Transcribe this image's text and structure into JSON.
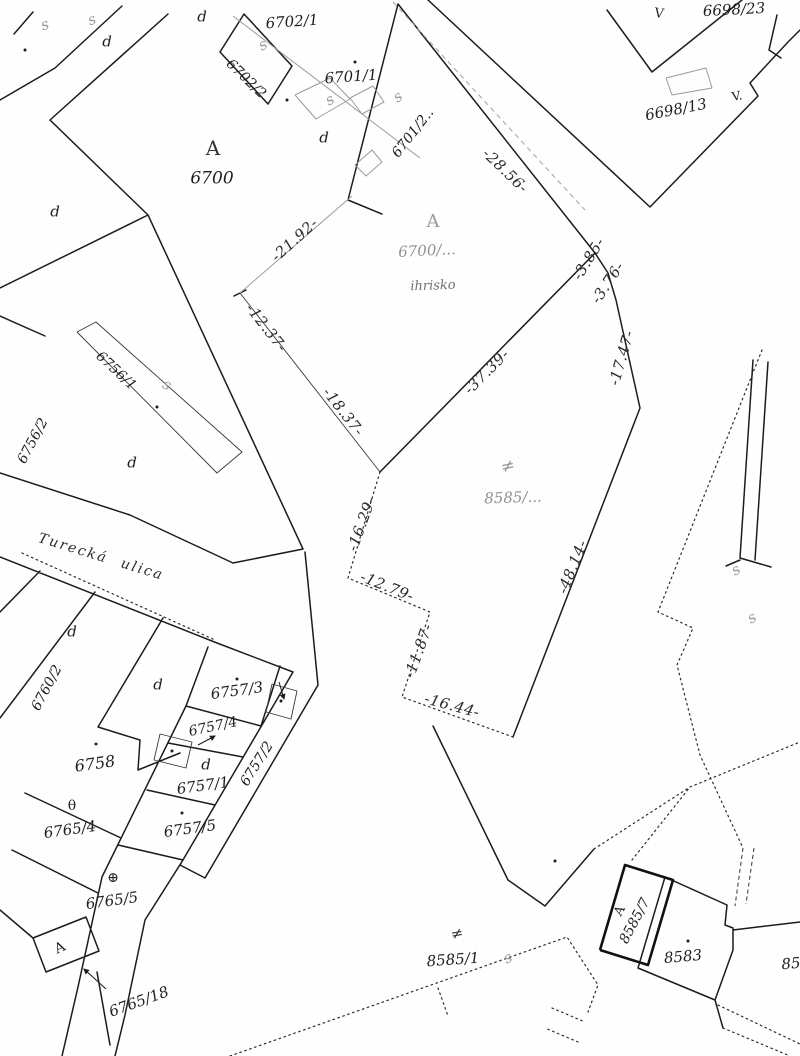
{
  "page": {
    "background": "#fefefe",
    "ink": "#1c1c1c",
    "faded_ink": "#919191",
    "kind": "cadastral map scan"
  },
  "street": {
    "label": "Turecká ulica",
    "x": 101,
    "y": 557,
    "rot": 17,
    "size": 14
  },
  "parcel_labels": [
    {
      "text": "6702/1",
      "x": 292,
      "y": 22,
      "rot": -4,
      "size": 15
    },
    {
      "text": "6702/2",
      "x": 246,
      "y": 79,
      "rot": 44,
      "size": 14
    },
    {
      "text": "6701/1",
      "x": 351,
      "y": 77,
      "rot": -4,
      "size": 15
    },
    {
      "text": "6701/2..",
      "x": 413,
      "y": 133,
      "rot": -52,
      "size": 14
    },
    {
      "text": "6700",
      "x": 212,
      "y": 179,
      "rot": 0,
      "size": 17
    },
    {
      "text": "6698/23",
      "x": 734,
      "y": 10,
      "rot": -3,
      "size": 15
    },
    {
      "text": "6698/13",
      "x": 676,
      "y": 110,
      "rot": -11,
      "size": 15
    },
    {
      "text": "6700/...",
      "x": 427,
      "y": 251,
      "rot": -3,
      "size": 15,
      "color": "#919191"
    },
    {
      "text": "ihrisko",
      "x": 433,
      "y": 286,
      "rot": -2,
      "size": 13,
      "color": "#6e6e6e"
    },
    {
      "text": "8585/...",
      "x": 513,
      "y": 498,
      "rot": -2,
      "size": 15,
      "color": "#919191"
    },
    {
      "text": "6756/1",
      "x": 116,
      "y": 371,
      "rot": 43,
      "size": 14
    },
    {
      "text": "6756/2",
      "x": 33,
      "y": 441,
      "rot": -62,
      "size": 14
    },
    {
      "text": "6760/2",
      "x": 47,
      "y": 688,
      "rot": -62,
      "size": 14
    },
    {
      "text": "6757/3",
      "x": 237,
      "y": 691,
      "rot": -8,
      "size": 15
    },
    {
      "text": "6757/4",
      "x": 213,
      "y": 727,
      "rot": -12,
      "size": 14
    },
    {
      "text": "6757/2",
      "x": 257,
      "y": 764,
      "rot": -58,
      "size": 14
    },
    {
      "text": "6757/1",
      "x": 203,
      "y": 786,
      "rot": -8,
      "size": 15
    },
    {
      "text": "6758",
      "x": 95,
      "y": 764,
      "rot": -8,
      "size": 16
    },
    {
      "text": "6757/5",
      "x": 190,
      "y": 829,
      "rot": -8,
      "size": 15
    },
    {
      "text": "6765/4",
      "x": 70,
      "y": 830,
      "rot": -8,
      "size": 15
    },
    {
      "text": "6765/5",
      "x": 112,
      "y": 901,
      "rot": -8,
      "size": 15
    },
    {
      "text": "6765/18",
      "x": 139,
      "y": 1002,
      "rot": -20,
      "size": 15
    },
    {
      "text": "8585/1",
      "x": 453,
      "y": 960,
      "rot": -4,
      "size": 15
    },
    {
      "text": "8585/7",
      "x": 635,
      "y": 921,
      "rot": -62,
      "size": 14
    },
    {
      "text": "8583",
      "x": 683,
      "y": 957,
      "rot": -5,
      "size": 15
    },
    {
      "text": "85",
      "x": 791,
      "y": 964,
      "rot": -5,
      "size": 15
    }
  ],
  "dimension_labels": [
    {
      "text": "-28.56-",
      "x": 505,
      "y": 171,
      "rot": 44
    },
    {
      "text": "-21.92-",
      "x": 295,
      "y": 240,
      "rot": -42
    },
    {
      "text": "-12.37-",
      "x": 266,
      "y": 328,
      "rot": 52
    },
    {
      "text": "-18.37-",
      "x": 343,
      "y": 412,
      "rot": 52
    },
    {
      "text": "-37.39-",
      "x": 487,
      "y": 372,
      "rot": -45
    },
    {
      "text": "-3.85-",
      "x": 589,
      "y": 259,
      "rot": -58
    },
    {
      "text": "-3.76-",
      "x": 608,
      "y": 283,
      "rot": -56
    },
    {
      "text": "-17.47-",
      "x": 622,
      "y": 358,
      "rot": -74
    },
    {
      "text": "-16.29-",
      "x": 362,
      "y": 524,
      "rot": -70
    },
    {
      "text": "-48.14-",
      "x": 573,
      "y": 567,
      "rot": -68
    },
    {
      "text": "-12.79-",
      "x": 387,
      "y": 587,
      "rot": 22
    },
    {
      "text": "-11.87-",
      "x": 419,
      "y": 651,
      "rot": -70
    },
    {
      "text": "-16.44-",
      "x": 452,
      "y": 706,
      "rot": 15
    }
  ],
  "letter_labels": [
    {
      "text": "d",
      "x": 107,
      "y": 42
    },
    {
      "text": "d",
      "x": 202,
      "y": 17
    },
    {
      "text": "d",
      "x": 324,
      "y": 138
    },
    {
      "text": "d",
      "x": 55,
      "y": 212
    },
    {
      "text": "d",
      "x": 132,
      "y": 463
    },
    {
      "text": "d",
      "x": 72,
      "y": 632
    },
    {
      "text": "d",
      "x": 158,
      "y": 685
    },
    {
      "text": "d",
      "x": 206,
      "y": 765
    }
  ],
  "symbol_labels": [
    {
      "glyph": "A",
      "meaning": "land-use-symbol",
      "x": 213,
      "y": 148,
      "rot": 0,
      "size": 20,
      "color": "#333333"
    },
    {
      "glyph": "A",
      "meaning": "land-use-symbol-faded",
      "x": 433,
      "y": 222,
      "rot": 0,
      "size": 18,
      "color": "#9a9a9a"
    },
    {
      "glyph": "A",
      "meaning": "building-symbol",
      "x": 620,
      "y": 911,
      "rot": -62,
      "size": 13,
      "color": "#222222"
    },
    {
      "glyph": "A",
      "meaning": "building-symbol",
      "x": 60,
      "y": 948,
      "rot": -25,
      "size": 14,
      "color": "#222222"
    },
    {
      "glyph": "≠",
      "meaning": "land-use-symbol-faded",
      "x": 508,
      "y": 467,
      "rot": -12,
      "size": 17,
      "color": "#9a9a9a"
    },
    {
      "glyph": "≠",
      "meaning": "land-use-symbol",
      "x": 457,
      "y": 934,
      "rot": -10,
      "size": 15,
      "color": "#3a3a3a"
    },
    {
      "glyph": "θ",
      "meaning": "tree-symbol",
      "x": 72,
      "y": 806,
      "rot": 0,
      "size": 14,
      "color": "#222222"
    },
    {
      "glyph": "⊕",
      "meaning": "tree-symbol",
      "x": 113,
      "y": 878,
      "rot": 0,
      "size": 14,
      "color": "#222222"
    },
    {
      "glyph": "V",
      "meaning": "v-mark",
      "x": 659,
      "y": 14,
      "rot": 8,
      "size": 13,
      "color": "#222222"
    },
    {
      "glyph": "V.",
      "meaning": "v-mark",
      "x": 737,
      "y": 96,
      "rot": -10,
      "size": 12,
      "color": "#222222"
    }
  ],
  "connector_symbols": [
    {
      "glyph": "s",
      "x": 45,
      "y": 25,
      "rot": -20
    },
    {
      "glyph": "s",
      "x": 92,
      "y": 20,
      "rot": -20
    },
    {
      "glyph": "s",
      "x": 263,
      "y": 45,
      "rot": -30
    },
    {
      "glyph": "s",
      "x": 330,
      "y": 100,
      "rot": -30
    },
    {
      "glyph": "s",
      "x": 398,
      "y": 97,
      "rot": -35
    },
    {
      "glyph": "s",
      "x": 167,
      "y": 385,
      "rot": 30
    },
    {
      "glyph": "s",
      "x": 508,
      "y": 958,
      "rot": -25
    },
    {
      "glyph": "s",
      "x": 736,
      "y": 570,
      "rot": -30
    },
    {
      "glyph": "s",
      "x": 752,
      "y": 618,
      "rot": -30
    }
  ],
  "survey_dots": [
    [
      287,
      100
    ],
    [
      355,
      62
    ],
    [
      96,
      744
    ],
    [
      237,
      679
    ],
    [
      182,
      813
    ],
    [
      281,
      701
    ],
    [
      172,
      751
    ],
    [
      688,
      941
    ],
    [
      157,
      407
    ],
    [
      25,
      50
    ],
    [
      555,
      861
    ]
  ]
}
